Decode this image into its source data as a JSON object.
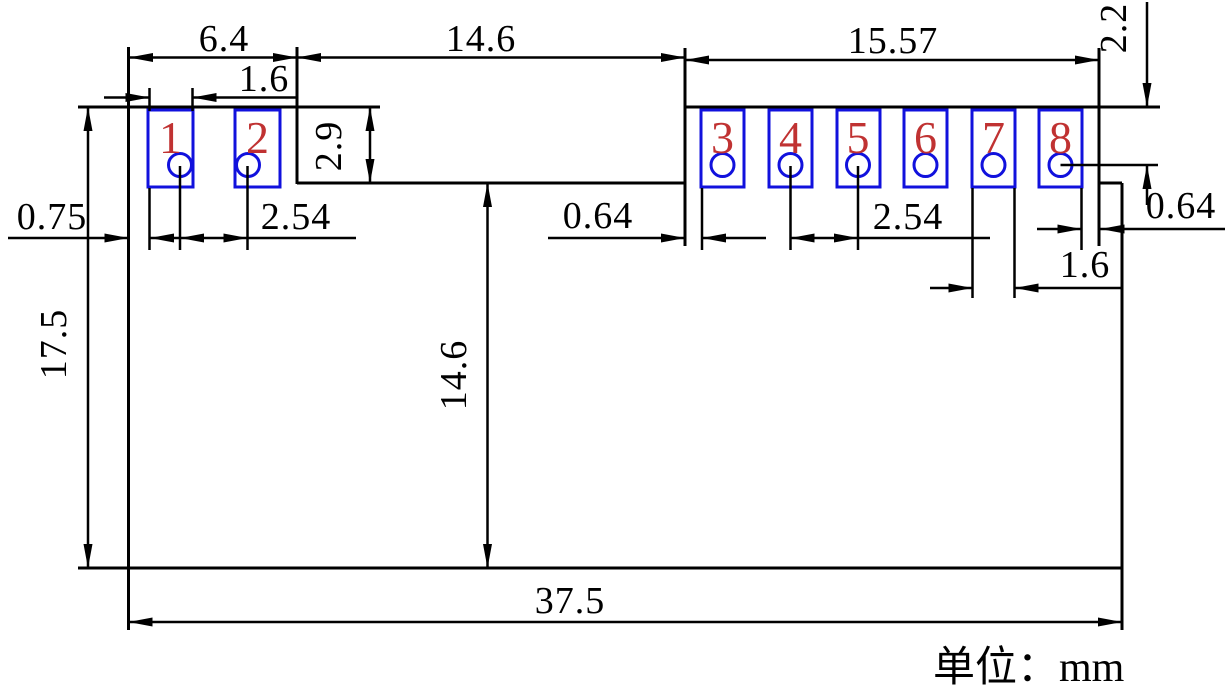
{
  "drawing": {
    "title": "pcb-module-footprint-dimension-drawing",
    "unit_label": "单位：mm",
    "colors": {
      "line": "#000000",
      "pad_outline": "#1111dd",
      "pad_number": "#c03232"
    },
    "pads": [
      {
        "number": "1"
      },
      {
        "number": "2"
      },
      {
        "number": "3"
      },
      {
        "number": "4"
      },
      {
        "number": "5"
      },
      {
        "number": "6"
      },
      {
        "number": "7"
      },
      {
        "number": "8"
      }
    ],
    "dimensions": {
      "left_section_width": "6.4",
      "pad1_width": "1.6",
      "middle_section_width": "14.6",
      "right_section_width": "15.57",
      "top_edge_to_hole8": "2.2",
      "left_edge_to_pad1": "0.75",
      "hole_pitch_left": "2.54",
      "notch_depth": "2.9",
      "total_height": "17.5",
      "middle_section_height": "14.6",
      "edge_to_pad3": "0.64",
      "hole_pitch_right": "2.54",
      "pad7_width": "1.6",
      "pad8_to_edge": "0.64",
      "total_width": "37.5"
    }
  }
}
